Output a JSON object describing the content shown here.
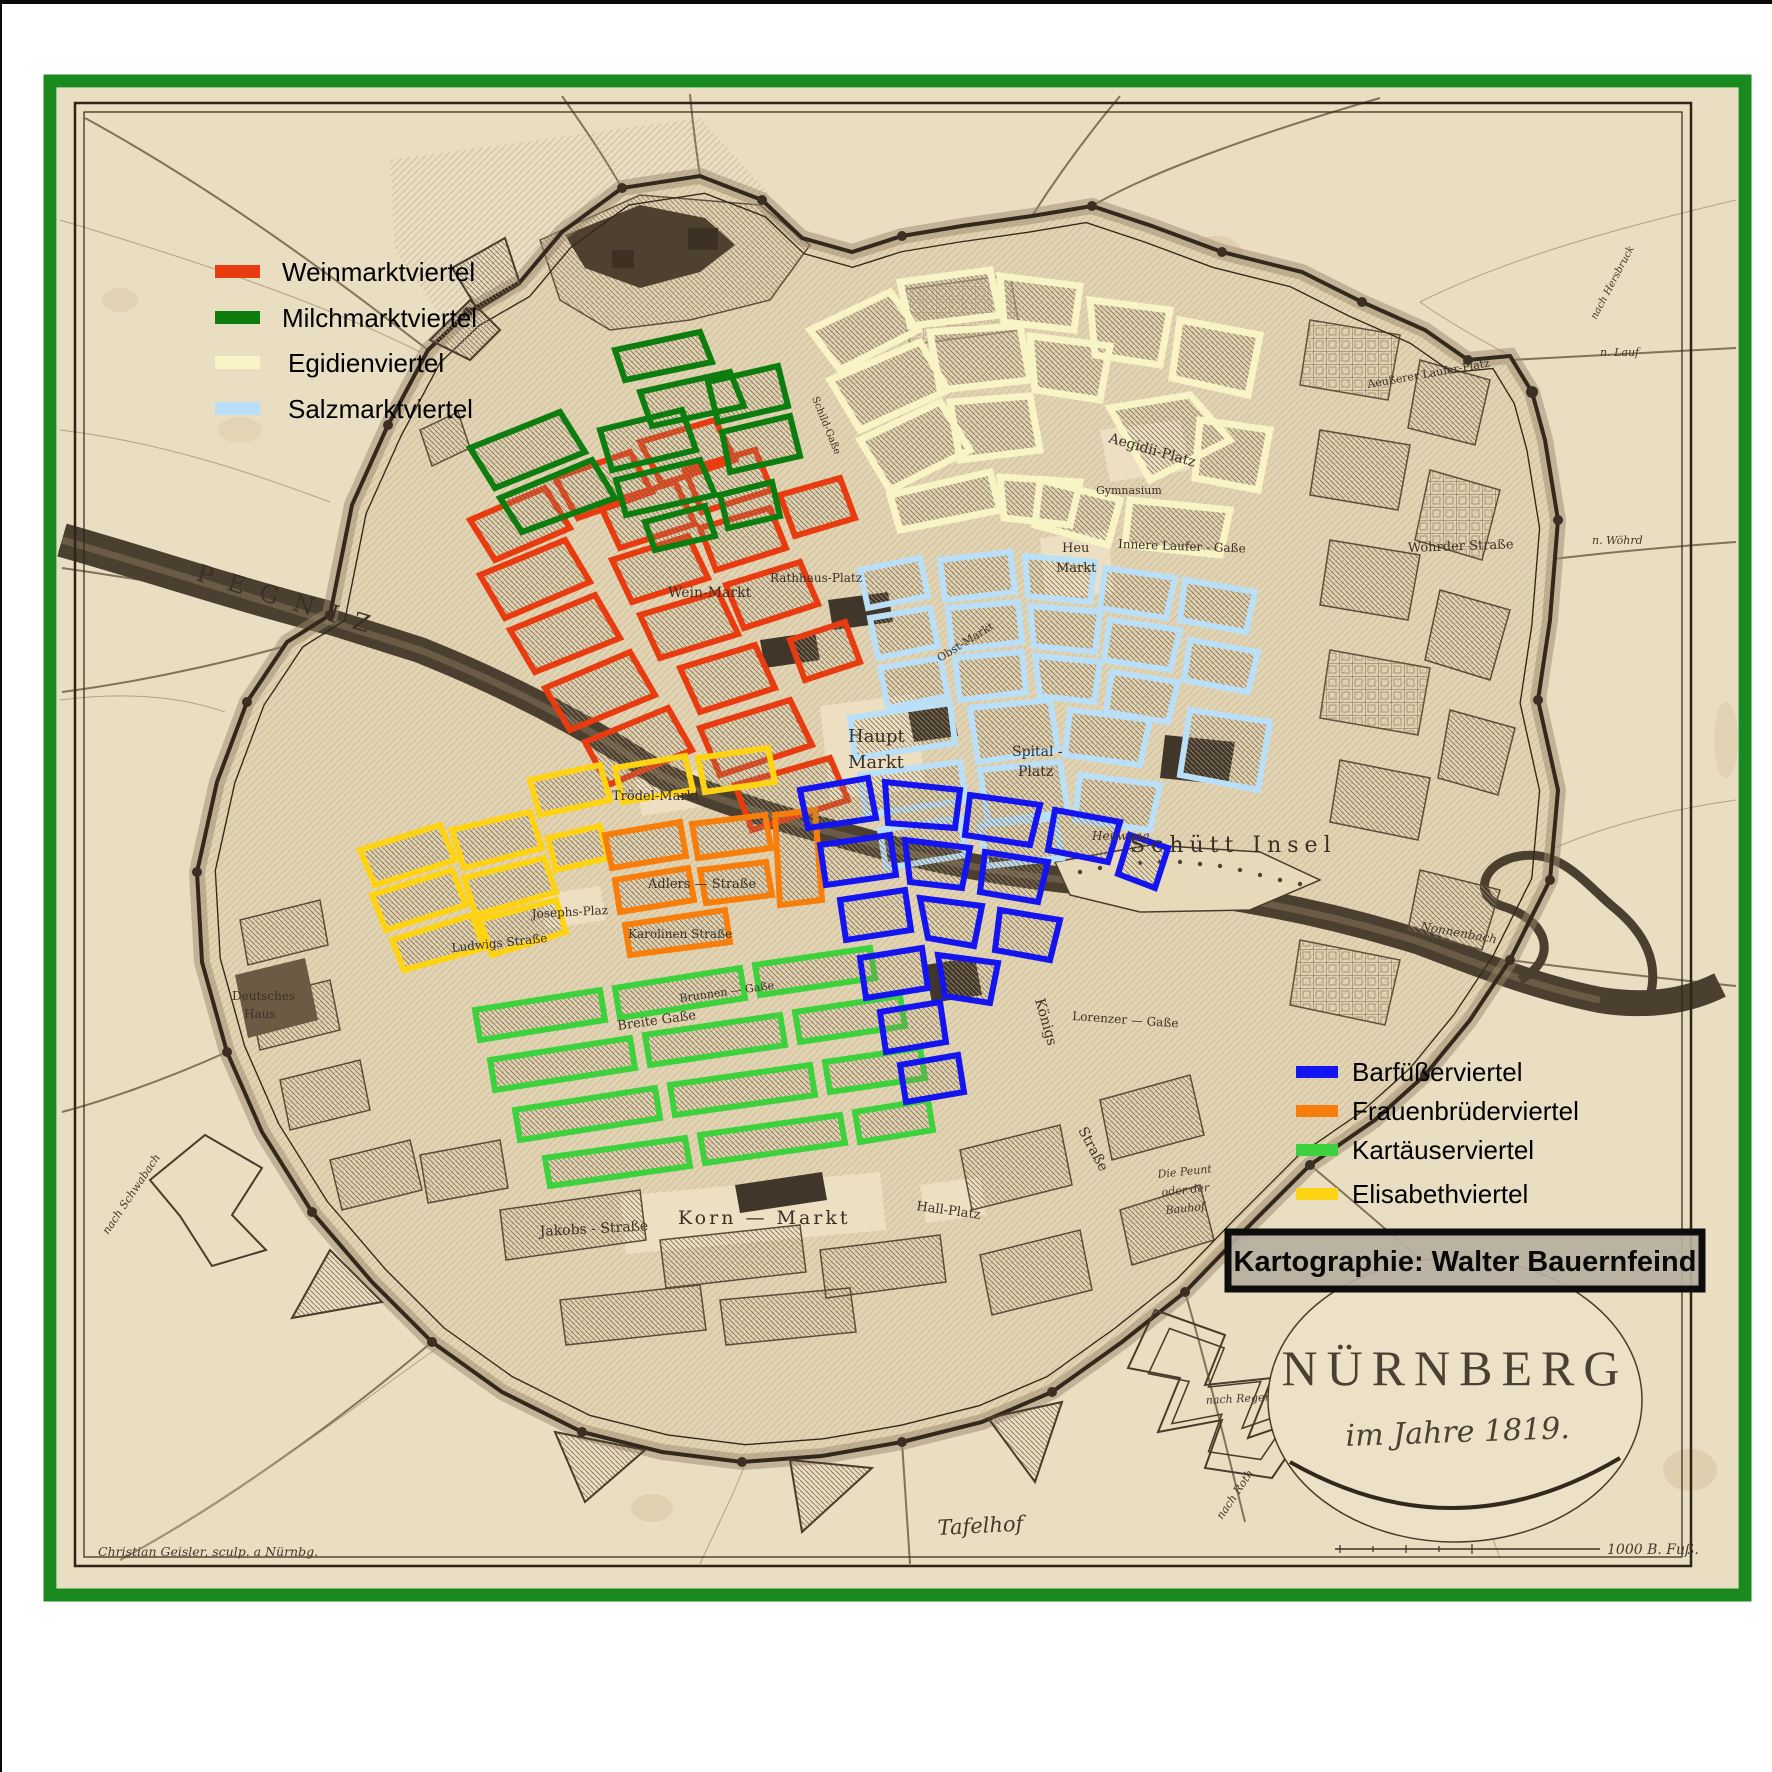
{
  "frame": {
    "border_color": "#1a8a1e"
  },
  "legend_left": {
    "items": [
      {
        "label": "Weinmarktviertel",
        "color": "#e93b10"
      },
      {
        "label": "Milchmarktviertel",
        "color": "#0e7d10"
      },
      {
        "label": "Egidienviertel",
        "color": "#f8f4c6"
      },
      {
        "label": "Salzmarktviertel",
        "color": "#b9e0f8"
      }
    ]
  },
  "legend_right": {
    "items": [
      {
        "label": "Barfüßerviertel",
        "color": "#1414f0"
      },
      {
        "label": "Frauenbrüderviertel",
        "color": "#f77e0b"
      },
      {
        "label": "Kartäuserviertel",
        "color": "#3dd23d"
      },
      {
        "label": "Elisabethviertel",
        "color": "#fed314"
      }
    ]
  },
  "credit": {
    "label": "Kartographie: Walter Bauernfeind"
  },
  "cartouche": {
    "title": "NÜRNBERG",
    "subtitle": "im Jahre 1819.",
    "scale_label": "1000 B. Fuß.",
    "engraver": "Christian Geisler, sculp. a Nürnbg."
  },
  "map_labels": {
    "pegnitz": "PEGNIZ",
    "haupt_1": "Haupt",
    "haupt_2": "Markt",
    "spital_1": "Spital -",
    "spital_2": "Platz",
    "schuett": "Schütt  Insel",
    "heuwaag": "Heuwaag",
    "troedel": "Trödel-Markt",
    "wein_markt": "Wein-Markt",
    "rathhaus": "Rathhaus-Platz",
    "obst": "Obst-Markt",
    "aegidii": "Aegidii-Platz",
    "gymnasium": "Gymnasium",
    "heu_1": "Heu",
    "heu_2": "Markt",
    "innere_laufer": "Innere  Laufer - Gaße",
    "schild": "Schild-Gaße",
    "woehrder": "Wöhrder  Straße",
    "aeusserer": "Aeußerer Laufer-Platz",
    "josephs": "Josephs-Plaz",
    "adlers": "Adlers  —  Straße",
    "karolinen": "Karolinen      Straße",
    "ludwigs": "Ludwigs  Straße",
    "breite": "Breite  Gaße",
    "brunnen": "Brunnen — Gaße",
    "korn": "Korn — Markt",
    "hall": "Hall-Platz",
    "jakobs": "Jakobs - Straße",
    "koenigs_1": "Königs",
    "koenigs_2": "Straße",
    "lorenzer": "Lorenzer — Gaße",
    "deutsches_1": "Deutsches",
    "deutsches_2": "Haus",
    "peunt_1": "Die Peunt",
    "peunt_2": "oder der",
    "peunt_3": "Bauhof",
    "nonnenbach": "Nonnenbach",
    "n_lauf": "n. Lauf",
    "n_woehrd": "n. Wöhrd",
    "nach_hersbruck": "nach Hersbruck",
    "tafelhof": "Tafelhof",
    "nach_schwabach": "nach Schwabach",
    "nach_regensburg": "nach Regensburg",
    "nach_roth": "nach Roth"
  }
}
